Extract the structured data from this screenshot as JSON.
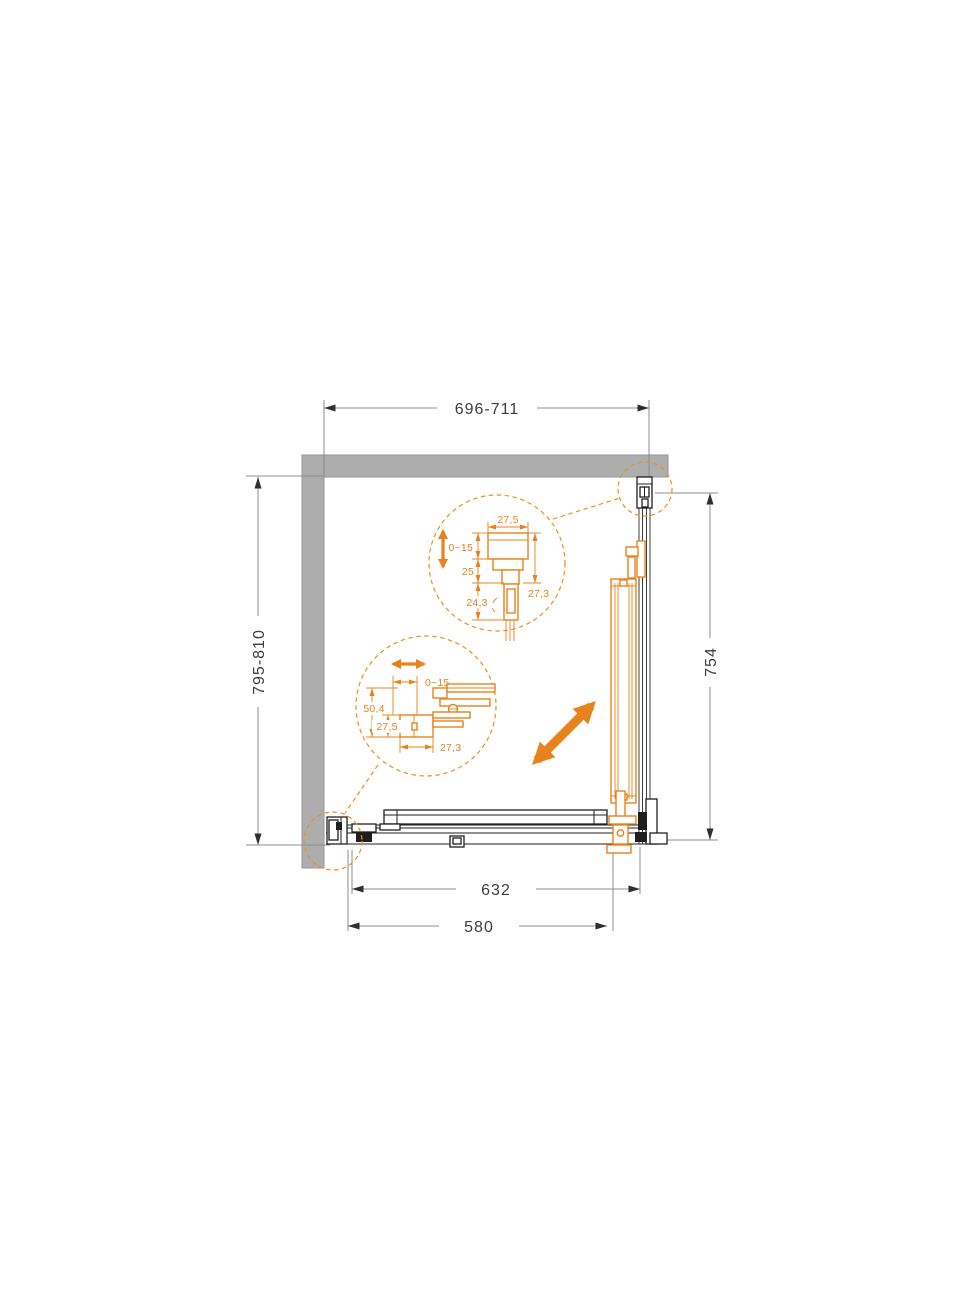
{
  "diagram": {
    "type": "shower-enclosure-installation-drawing",
    "view": "top-plan",
    "colors": {
      "accent_orange": "#E8821C",
      "wall_gray": "#ADADAD",
      "dimension_line_gray": "#8C8C8C",
      "dimension_text": "#3C3C3C",
      "profile_black": "#1F1F1F",
      "background": "#FFFFFF"
    },
    "overall_dimensions": {
      "top_width_range": "696-711",
      "left_depth_range": "795-810",
      "right_panel_width": "754",
      "door_panel_width": "632",
      "door_opening_width": "580"
    },
    "detail_wall_profile": {
      "profile_width": "27,5",
      "adjustment_range": "0~15",
      "inner_depth": "25",
      "holder_depth": "24,3",
      "side_depth": "27,3"
    },
    "detail_floor_profile": {
      "adjustment_range": "0~15",
      "assembly_height": "50,4",
      "profile_height": "27,5",
      "profile_width": "27,3"
    },
    "icons": {
      "vertical_adjustment": "double-arrow-vertical",
      "horizontal_adjustment": "double-arrow-horizontal",
      "door_slide_direction": "double-arrow-diagonal"
    }
  }
}
